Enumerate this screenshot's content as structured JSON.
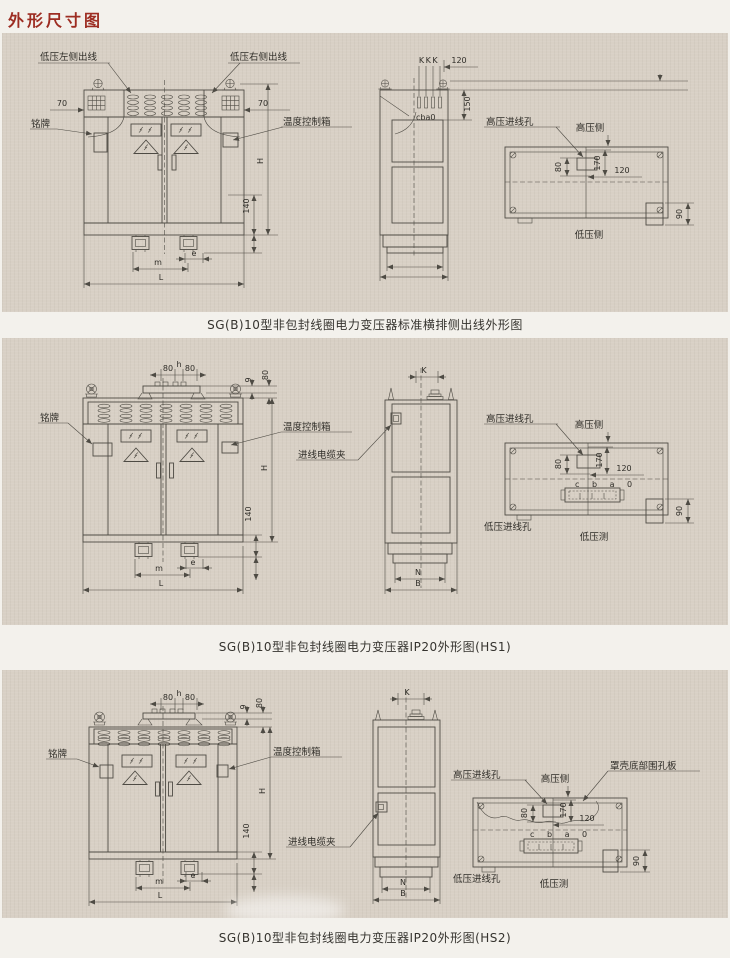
{
  "page": {
    "title": "外形尺寸图"
  },
  "captions": {
    "p1": "SG(B)10型非包封线圈电力变压器标准横排侧出线外形图",
    "p2": "SG(B)10型非包封线圈电力变压器IP20外形图(HS1)",
    "p3": "SG(B)10型非包封线圈电力变压器IP20外形图(HS2)"
  },
  "labels": {
    "lv_left": "低压左侧出线",
    "lv_right": "低压右侧出线",
    "nameplate": "铭牌",
    "temp_box": "温度控制箱",
    "cable_clamp": "进线电缆夹",
    "hv_hole": "高压进线孔",
    "lv_hole": "低压进线孔",
    "hv_side": "高压侧",
    "lv_side": "低压侧",
    "lv_side_b": "低压测",
    "shell_plate": "罩壳底部围孔板",
    "kkk": "KKK",
    "cba0": "cba0",
    "cbao": "c b a 0"
  },
  "dims": {
    "d9": "9",
    "d70": "70",
    "d80": "80",
    "d90": "90",
    "d120": "120",
    "d140": "140",
    "d150": "150",
    "d170": "170",
    "h": "h",
    "H": "H",
    "K": "K",
    "L": "L",
    "m": "m",
    "e": "e",
    "N": "N",
    "B": "B"
  },
  "colors": {
    "title_red": "#9d2d22",
    "panel_bg": "#d8d0c5",
    "page_bg": "#f3f1ec",
    "line": "#4e4b44",
    "text": "#2f2d28"
  }
}
